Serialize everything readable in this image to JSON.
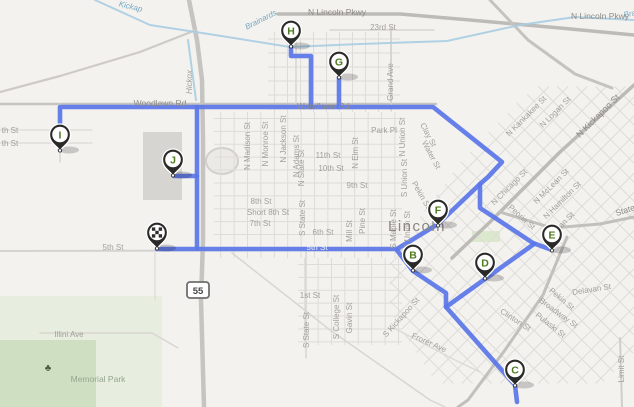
{
  "map": {
    "title": "Route map of Lincoln with stops B-J and start depot",
    "city_label": "Lincoln",
    "background_color": "#f3f2ef",
    "route_color": "#5b76e8",
    "water_color": "#a8cde2",
    "grid_road_color": "#dedcd8",
    "marker_letter_color": "#4e7a1e",
    "marker_pin_color": "#2a2a28",
    "highway_shield": {
      "text": "55",
      "x": 187,
      "y": 282,
      "w": 22,
      "h": 16
    },
    "tree_icon": {
      "glyph": "♣",
      "x": 48,
      "y": 371,
      "color": "#4d5e43"
    },
    "green_areas": [
      {
        "x": 0,
        "y": 296,
        "w": 162,
        "h": 111,
        "c": "#e7eddf"
      },
      {
        "x": 0,
        "y": 340,
        "w": 96,
        "h": 67,
        "c": "#cfe0c2"
      },
      {
        "x": 472,
        "y": 231,
        "w": 28,
        "h": 11,
        "c": "#dbe8cc"
      }
    ],
    "buildings": [
      {
        "x": 143,
        "y": 132,
        "w": 39,
        "h": 68,
        "c": "#d7d5d1"
      }
    ],
    "stadium": {
      "cx": 222,
      "cy": 161,
      "rx": 16,
      "ry": 13
    },
    "grids": [
      {
        "type": "ortho",
        "x0": 214,
        "y0": 112,
        "x1": 402,
        "y1": 258,
        "sx": 13.4,
        "sy": 12.9
      },
      {
        "type": "ortho",
        "x0": 268,
        "y0": 32,
        "x1": 400,
        "y1": 112,
        "sx": 13,
        "sy": 14
      },
      {
        "type": "ortho",
        "x0": 298,
        "y0": 258,
        "x1": 402,
        "y1": 345,
        "sx": 13.4,
        "sy": 12.9
      },
      {
        "type": "diag",
        "cx": 515,
        "cy": 235,
        "spacing": 13.5,
        "count": 26,
        "len": 420,
        "clip": [
          [
            390,
            258
          ],
          [
            462,
            160
          ],
          [
            520,
            100
          ],
          [
            575,
            58
          ],
          [
            634,
            58
          ],
          [
            634,
            352
          ],
          [
            578,
            407
          ],
          [
            452,
            407
          ],
          [
            390,
            312
          ]
        ]
      }
    ],
    "roads": [
      {
        "pts": [
          [
            278,
            14
          ],
          [
            400,
            14
          ],
          [
            470,
            20
          ],
          [
            560,
            28
          ],
          [
            634,
            35
          ]
        ],
        "w": 3.5,
        "c": "#bdbbb7"
      },
      {
        "pts": [
          [
            490,
            0
          ],
          [
            528,
            40
          ],
          [
            575,
            74
          ],
          [
            612,
            88
          ]
        ],
        "w": 3,
        "c": "#c5c3bf"
      },
      {
        "pts": [
          [
            634,
            85
          ],
          [
            560,
            152
          ],
          [
            490,
            222
          ],
          [
            452,
            258
          ]
        ],
        "w": 3.5,
        "c": "#bdbbb7"
      },
      {
        "pts": [
          [
            500,
            212
          ],
          [
            552,
            228
          ],
          [
            600,
            224
          ],
          [
            634,
            217
          ]
        ],
        "w": 3,
        "c": "#c2c0bc"
      },
      {
        "pts": [
          [
            567,
            237
          ],
          [
            543,
            295
          ],
          [
            505,
            350
          ],
          [
            468,
            400
          ],
          [
            458,
            407
          ]
        ],
        "w": 3,
        "c": "#c2c0bc"
      },
      {
        "pts": [
          [
            0,
            104
          ],
          [
            436,
            104
          ]
        ],
        "w": 2.5,
        "c": "#c6c4c0"
      },
      {
        "pts": [
          [
            189,
            0
          ],
          [
            197,
            40
          ],
          [
            202,
            80
          ],
          [
            203,
            140
          ],
          [
            203,
            240
          ],
          [
            201,
            300
          ],
          [
            204,
            407
          ]
        ],
        "w": 4.5,
        "c": "#c6c4c0"
      },
      {
        "pts": [
          [
            196,
            30
          ],
          [
            140,
            52
          ],
          [
            60,
            76
          ],
          [
            0,
            92
          ]
        ],
        "w": 2.2,
        "c": "#cecbc7"
      },
      {
        "pts": [
          [
            0,
            251
          ],
          [
            410,
            250
          ]
        ],
        "w": 2,
        "c": "#d5d3cf"
      },
      {
        "pts": [
          [
            391,
            28
          ],
          [
            391,
            110
          ]
        ],
        "w": 1.8,
        "c": "#d5d3cf"
      },
      {
        "pts": [
          [
            330,
            30
          ],
          [
            434,
            30
          ]
        ],
        "w": 1.5,
        "c": "#d8d6d2"
      },
      {
        "pts": [
          [
            620,
            338
          ],
          [
            622,
            407
          ]
        ],
        "w": 2,
        "c": "#d0cec9"
      },
      {
        "pts": [
          [
            60,
            104
          ],
          [
            60,
            162
          ]
        ],
        "w": 1.5,
        "c": "#d8d6d2"
      },
      {
        "pts": [
          [
            0,
            130
          ],
          [
            92,
            130
          ]
        ],
        "w": 1.2,
        "c": "#dcdad6"
      },
      {
        "pts": [
          [
            0,
            143
          ],
          [
            92,
            143
          ]
        ],
        "w": 1.2,
        "c": "#dcdad6"
      },
      {
        "pts": [
          [
            306,
            250
          ],
          [
            306,
            358
          ]
        ],
        "w": 1.5,
        "c": "#d8d6d2"
      },
      {
        "pts": [
          [
            232,
            253
          ],
          [
            330,
            330
          ],
          [
            430,
            400
          ],
          [
            445,
            407
          ]
        ],
        "w": 1.5,
        "c": "#d8d6d2"
      },
      {
        "pts": [
          [
            40,
            333
          ],
          [
            152,
            333
          ],
          [
            178,
            348
          ]
        ],
        "w": 1.5,
        "c": "#d8d6d2"
      },
      {
        "pts": [
          [
            390,
            326
          ],
          [
            455,
            360
          ],
          [
            480,
            372
          ]
        ],
        "w": 1.3,
        "c": "#dcdad6"
      },
      {
        "pts": [
          [
            155,
            250
          ],
          [
            155,
            300
          ]
        ],
        "w": 1.2,
        "c": "#dcdad6"
      },
      {
        "pts": [
          [
            296,
            104
          ],
          [
            296,
            30
          ]
        ],
        "w": 1.5,
        "c": "#d8d6d2"
      }
    ],
    "creeks": [
      {
        "pts": [
          [
            95,
            0
          ],
          [
            150,
            25
          ],
          [
            215,
            35
          ],
          [
            290,
            47
          ],
          [
            360,
            44
          ],
          [
            447,
            41
          ],
          [
            520,
            25
          ],
          [
            575,
            17
          ],
          [
            634,
            20
          ]
        ]
      },
      {
        "pts": [
          [
            188,
            40
          ],
          [
            192,
            70
          ],
          [
            196,
            100
          ]
        ]
      }
    ],
    "route_segments": [
      [
        [
          60,
          150
        ],
        [
          60,
          107
        ],
        [
          433,
          107
        ],
        [
          502,
          162
        ],
        [
          488,
          177
        ],
        [
          480,
          184
        ],
        [
          480,
          208
        ],
        [
          533,
          243
        ],
        [
          552,
          250
        ]
      ],
      [
        [
          291,
          46
        ],
        [
          291,
          56
        ],
        [
          311,
          56
        ],
        [
          311,
          107
        ]
      ],
      [
        [
          339,
          77
        ],
        [
          339,
          107
        ]
      ],
      [
        [
          197,
          107
        ],
        [
          197,
          248
        ]
      ],
      [
        [
          174,
          176
        ],
        [
          197,
          176
        ]
      ],
      [
        [
          157,
          249
        ],
        [
          396,
          249
        ],
        [
          413,
          271
        ],
        [
          446,
          293
        ],
        [
          446,
          307
        ],
        [
          515,
          385
        ],
        [
          517,
          402
        ]
      ],
      [
        [
          480,
          184
        ],
        [
          438,
          224
        ],
        [
          397,
          249
        ]
      ],
      [
        [
          534,
          244
        ],
        [
          485,
          279
        ],
        [
          446,
          307
        ]
      ]
    ],
    "labels": [
      {
        "text": "Kickap",
        "x": 130,
        "y": 9,
        "r": 14,
        "c": "#74a9c4",
        "i": true,
        "s": 8
      },
      {
        "text": "Brainards",
        "x": 262,
        "y": 22,
        "r": -27,
        "c": "#74a9c4",
        "i": true,
        "s": 8
      },
      {
        "text": "Brainards",
        "x": 641,
        "y": 14,
        "r": -12,
        "c": "#74a9c4",
        "i": true,
        "s": 8
      },
      {
        "text": "N Lincoln Pkwy",
        "x": 337,
        "y": 15,
        "s": 8.5,
        "c": "#8f8c86"
      },
      {
        "text": "N Lincoln Pkwy",
        "x": 600,
        "y": 19,
        "s": 8.5,
        "c": "#8f8c86"
      },
      {
        "text": "23rd St",
        "x": 383,
        "y": 30,
        "s": 8
      },
      {
        "text": "Grand Ave",
        "x": 393,
        "y": 82,
        "r": -90,
        "s": 8
      },
      {
        "text": "Hickox",
        "x": 192,
        "y": 82,
        "r": -90,
        "i": true,
        "s": 8
      },
      {
        "text": "Woodlawn Rd",
        "x": 160,
        "y": 106,
        "s": 8.5,
        "c": "#8f8c86"
      },
      {
        "text": "Woodlawn Rd",
        "x": 323,
        "y": 109,
        "s": 8.5,
        "c": "#8f8c86"
      },
      {
        "text": "Park Pl",
        "x": 384,
        "y": 133,
        "s": 8
      },
      {
        "text": "th St",
        "x": 10,
        "y": 133,
        "s": 8
      },
      {
        "text": "th St",
        "x": 10,
        "y": 146,
        "s": 8
      },
      {
        "text": "11th St",
        "x": 328,
        "y": 158,
        "s": 8
      },
      {
        "text": "10th St",
        "x": 331,
        "y": 171,
        "s": 8
      },
      {
        "text": "9th St",
        "x": 357,
        "y": 188,
        "s": 8
      },
      {
        "text": "8th St",
        "x": 261,
        "y": 204,
        "s": 8
      },
      {
        "text": "Short 8th St",
        "x": 268,
        "y": 215,
        "s": 8
      },
      {
        "text": "7th St",
        "x": 260,
        "y": 226,
        "s": 8
      },
      {
        "text": "6th St",
        "x": 323,
        "y": 235,
        "s": 8
      },
      {
        "text": "5th St",
        "x": 113,
        "y": 250,
        "s": 8
      },
      {
        "text": "5th St",
        "x": 317,
        "y": 250,
        "s": 8,
        "c": "#eef0fa"
      },
      {
        "text": "1st St",
        "x": 310,
        "y": 298,
        "s": 8
      },
      {
        "text": "S College St",
        "x": 339,
        "y": 317,
        "r": -90,
        "s": 8
      },
      {
        "text": "Gavin St",
        "x": 352,
        "y": 318,
        "r": -90,
        "s": 8
      },
      {
        "text": "S State St",
        "x": 309,
        "y": 330,
        "r": -90,
        "s": 8
      },
      {
        "text": "N Madison St",
        "x": 250,
        "y": 146,
        "r": -90,
        "s": 8
      },
      {
        "text": "N Monroe St",
        "x": 268,
        "y": 144,
        "r": -90,
        "s": 8
      },
      {
        "text": "N Jackson St",
        "x": 286,
        "y": 139,
        "r": -90,
        "s": 8
      },
      {
        "text": "N Adams St",
        "x": 299,
        "y": 156,
        "r": -90,
        "s": 8
      },
      {
        "text": "N State St",
        "x": 304,
        "y": 168,
        "r": -90,
        "s": 8
      },
      {
        "text": "S State St",
        "x": 305,
        "y": 218,
        "r": -90,
        "s": 8
      },
      {
        "text": "N Elm St",
        "x": 358,
        "y": 153,
        "r": -90,
        "s": 8
      },
      {
        "text": "Pine St",
        "x": 365,
        "y": 221,
        "r": -90,
        "s": 8
      },
      {
        "text": "Mill St",
        "x": 352,
        "y": 231,
        "r": -90,
        "s": 8
      },
      {
        "text": "S Maple St",
        "x": 396,
        "y": 229,
        "r": -90,
        "s": 8
      },
      {
        "text": "N Union St",
        "x": 405,
        "y": 137,
        "r": -90,
        "s": 8
      },
      {
        "text": "S Union St",
        "x": 407,
        "y": 178,
        "r": -90,
        "s": 8
      },
      {
        "text": "S Union St",
        "x": 410,
        "y": 230,
        "r": -90,
        "s": 8
      },
      {
        "text": "Clay St",
        "x": 426,
        "y": 136,
        "r": 62,
        "s": 8
      },
      {
        "text": "Water St",
        "x": 429,
        "y": 156,
        "r": 62,
        "s": 8
      },
      {
        "text": "Pekin St",
        "x": 419,
        "y": 196,
        "r": 60,
        "s": 8
      },
      {
        "text": "Lincoln",
        "x": 417,
        "y": 231,
        "s": 15,
        "c": "#8a8781",
        "ls": 1.5
      },
      {
        "text": "Peoria St",
        "x": 520,
        "y": 219,
        "r": 42,
        "s": 8
      },
      {
        "text": "N Chicago St",
        "x": 511,
        "y": 189,
        "r": -45,
        "s": 8
      },
      {
        "text": "N McLean St",
        "x": 553,
        "y": 188,
        "r": -45,
        "s": 8
      },
      {
        "text": "N Hamilton St",
        "x": 564,
        "y": 202,
        "r": -45,
        "s": 8
      },
      {
        "text": "Sheridan St",
        "x": 560,
        "y": 230,
        "r": -45,
        "s": 8
      },
      {
        "text": "N Kankakee St",
        "x": 528,
        "y": 118,
        "r": -45,
        "s": 8
      },
      {
        "text": "N Logan St",
        "x": 557,
        "y": 114,
        "r": -45,
        "s": 8
      },
      {
        "text": "N Kickapoo St",
        "x": 600,
        "y": 118,
        "r": -45,
        "s": 9,
        "c": "#8f8c86"
      },
      {
        "text": "S Kickapoo St",
        "x": 403,
        "y": 319,
        "r": -48,
        "s": 8
      },
      {
        "text": "State",
        "x": 626,
        "y": 213,
        "r": -18,
        "s": 8.5,
        "c": "#8f8c86"
      },
      {
        "text": "Delavan St",
        "x": 592,
        "y": 292,
        "r": -9,
        "s": 8
      },
      {
        "text": "Pekin St",
        "x": 560,
        "y": 301,
        "r": 40,
        "s": 8
      },
      {
        "text": "Broadway St",
        "x": 557,
        "y": 315,
        "r": 36,
        "s": 8
      },
      {
        "text": "Pulaski St",
        "x": 549,
        "y": 327,
        "r": 38,
        "s": 8
      },
      {
        "text": "Clinton St",
        "x": 514,
        "y": 322,
        "r": 33,
        "s": 8
      },
      {
        "text": "Frorer Ave",
        "x": 428,
        "y": 345,
        "r": 24,
        "s": 8
      },
      {
        "text": "Limit St",
        "x": 624,
        "y": 369,
        "r": -90,
        "s": 8
      },
      {
        "text": "Illini Ave",
        "x": 69,
        "y": 337,
        "s": 8
      },
      {
        "text": "Memorial Park",
        "x": 98,
        "y": 382,
        "s": 8.5,
        "c": "#94a58d"
      }
    ],
    "markers": [
      {
        "id": "start",
        "type": "start",
        "x": 157,
        "y": 249
      },
      {
        "id": "B",
        "x": 413,
        "y": 271
      },
      {
        "id": "C",
        "x": 515,
        "y": 386
      },
      {
        "id": "D",
        "x": 485,
        "y": 279
      },
      {
        "id": "E",
        "x": 552,
        "y": 251
      },
      {
        "id": "F",
        "x": 438,
        "y": 226
      },
      {
        "id": "G",
        "x": 339,
        "y": 78
      },
      {
        "id": "H",
        "x": 291,
        "y": 47
      },
      {
        "id": "I",
        "x": 60,
        "y": 151
      },
      {
        "id": "J",
        "x": 173,
        "y": 176
      }
    ]
  }
}
